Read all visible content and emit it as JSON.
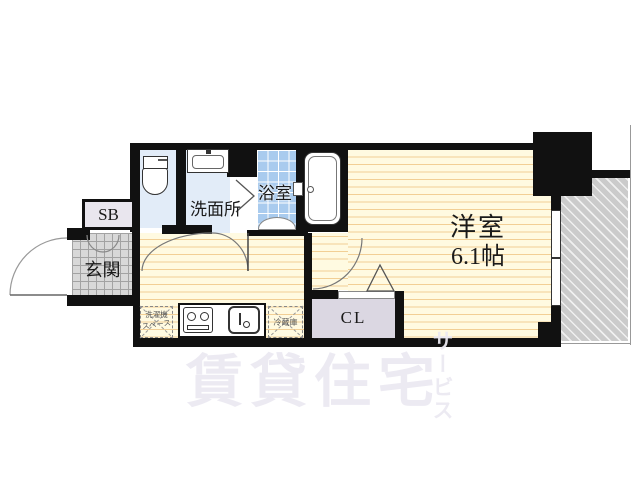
{
  "floorplan": {
    "type": "apartment-floor-plan",
    "rooms": {
      "western_room": {
        "name": "洋室",
        "size": "6.1帖"
      },
      "bathroom": {
        "name": "浴室"
      },
      "washroom": {
        "name": "洗面所"
      },
      "entrance": {
        "name": "玄関"
      },
      "shoe_box": {
        "label": "SB"
      },
      "closet": {
        "label": "CL"
      }
    },
    "kitchen": {
      "washer_space_line1": "洗濯機",
      "washer_space_line2": "スペース",
      "refrigerator_label": "冷蔵庫"
    },
    "watermark": {
      "main_text": "賃貸住宅",
      "vertical_text": "サービス"
    },
    "colors": {
      "wall": "#111111",
      "tatami_floor": "#FFFAE1",
      "tatami_line": "#F2CF95",
      "bath_tile": "#A9CBEE",
      "wet_room_floor": "#E2ECF8",
      "entrance_tile": "#D8D8D8",
      "closet_fill": "#DBD7E2",
      "balcony_fill": "#CBCBCB",
      "watermark": "#EBE9F1"
    }
  }
}
